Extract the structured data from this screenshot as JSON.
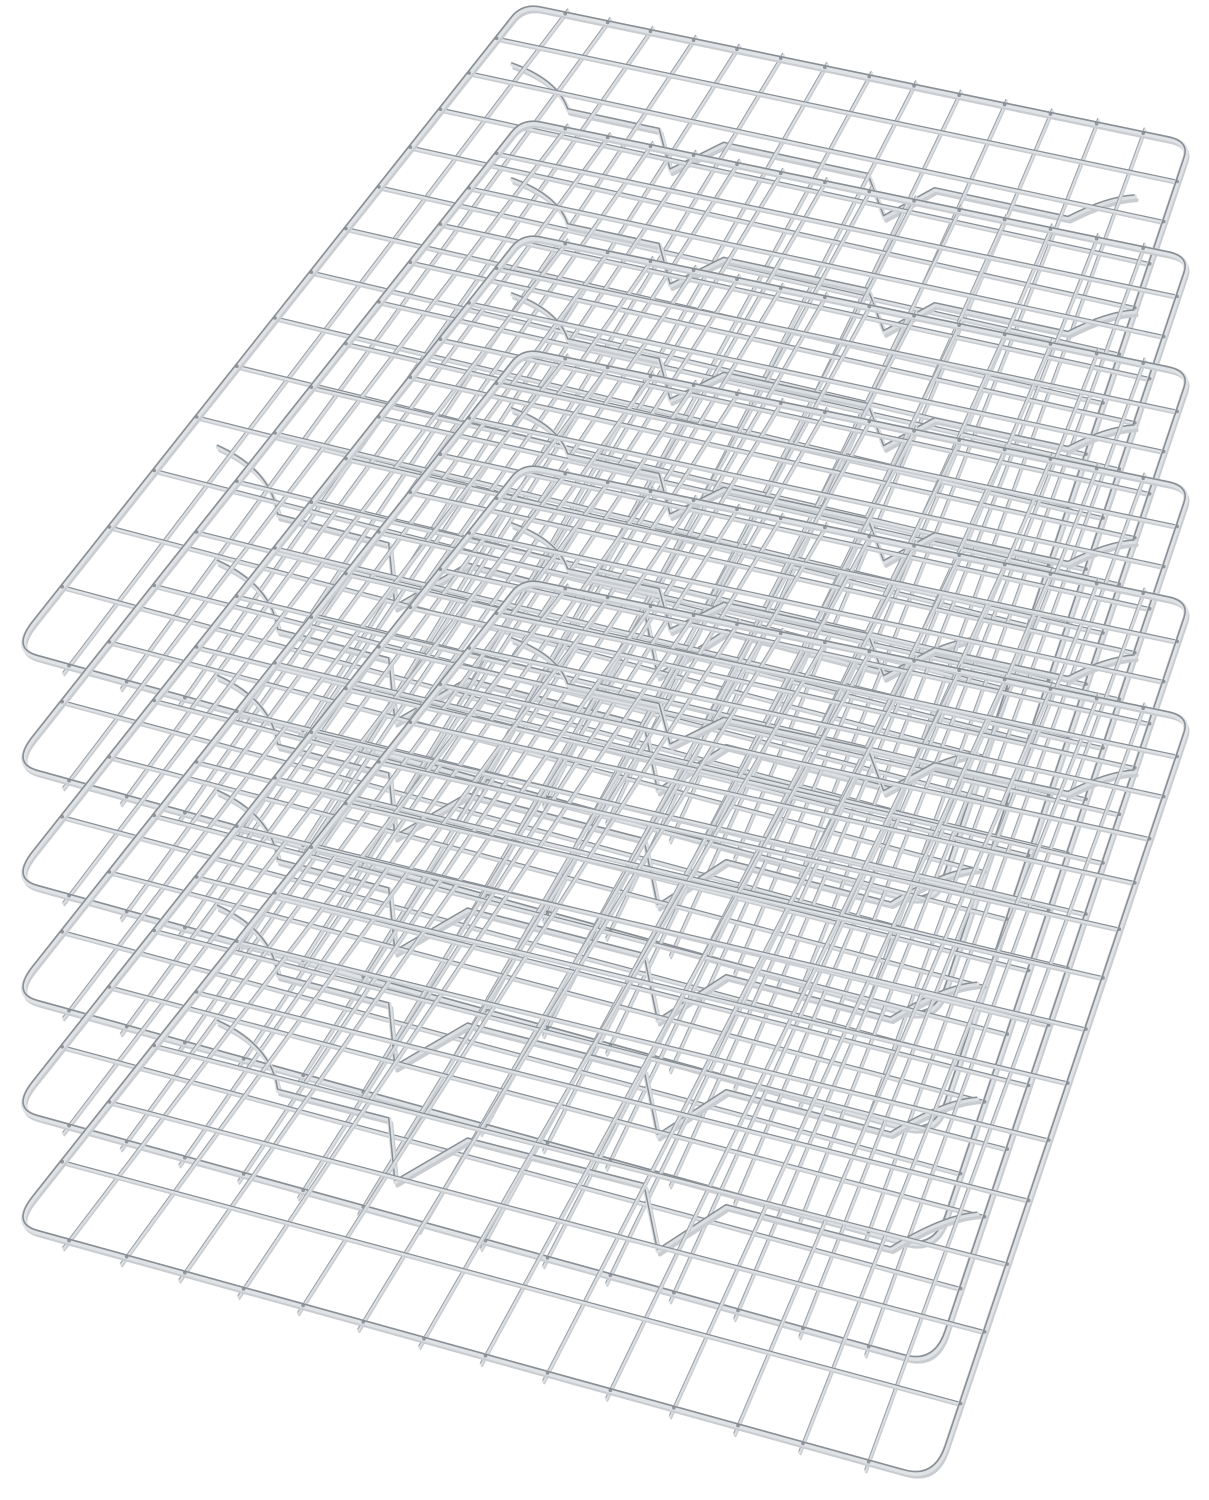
{
  "scene": {
    "description": "Product photo of six identical stainless steel wire cooling racks stacked and fanned diagonally on a plain white background, viewed from an elevated angle",
    "product": "oven-safe wire cooling and baking rack",
    "material": "stainless steel",
    "rack_count": 6,
    "rack": {
      "grid_columns": 15,
      "grid_rows": 14,
      "support_bands": 2,
      "feet_per_band": 2,
      "corner_style": "rounded"
    },
    "colors": {
      "background": "#ffffff",
      "steel_highlight": "#e0e3e6",
      "steel_light": "#dde0e3",
      "steel_mid": "#9aa1a7",
      "steel_dark": "#878e94",
      "steel_shadow": "#c9cdd1",
      "weld_joint": "#82898f"
    }
  }
}
